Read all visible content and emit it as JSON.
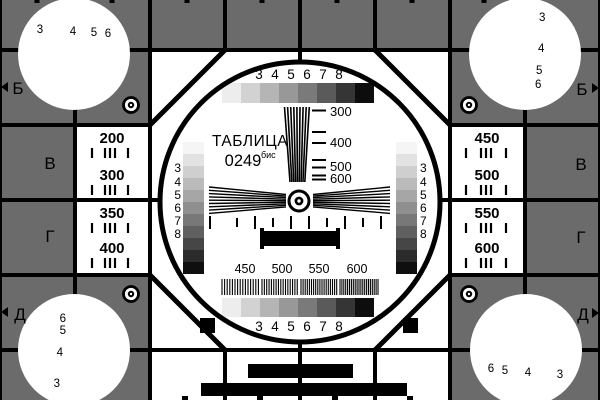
{
  "card": {
    "title_word": "ТАБЛИЦА",
    "title_number": "0249",
    "title_suffix": "бис"
  },
  "colors": {
    "background_gray": "#6b6b6b",
    "panel_white": "#ffffff",
    "line_black": "#000000"
  },
  "edge_markers": {
    "left": [
      "Б",
      "В",
      "Г",
      "Д"
    ],
    "right": [
      "Б",
      "В",
      "Г",
      "Д"
    ]
  },
  "gray_scale_labels": [
    "3",
    "4",
    "5",
    "6",
    "7",
    "8"
  ],
  "side_scale_labels": [
    "3",
    "4",
    "5",
    "6",
    "7",
    "8"
  ],
  "wedge_scale_labels": [
    "300",
    "400",
    "500",
    "600"
  ],
  "frequency_labels": [
    "450",
    "500",
    "550",
    "600"
  ],
  "left_cells": {
    "row1": [
      "200",
      "300"
    ],
    "row2": [
      "350",
      "400"
    ]
  },
  "right_cells": {
    "row1": [
      "450",
      "500"
    ],
    "row2": [
      "550",
      "600"
    ]
  },
  "corner_wedge_labels": {
    "top_left": [
      "3",
      "4",
      "5",
      "6"
    ],
    "top_right": [
      "3",
      "4",
      "5",
      "6"
    ],
    "bottom_left": [
      "6",
      "5",
      "4",
      "3"
    ],
    "bottom_right": [
      "6",
      "5",
      "4",
      "3"
    ]
  },
  "gray_steps_horizontal": [
    "#ededed",
    "#d2d2d2",
    "#b5b5b5",
    "#989898",
    "#7a7a7a",
    "#5a5a5a",
    "#353535",
    "#0d0d0d"
  ],
  "gray_steps_vertical": [
    "#f5f5f5",
    "#e2e2e2",
    "#cfcfcf",
    "#bbbbbb",
    "#a6a6a6",
    "#8f8f8f",
    "#787878",
    "#606060",
    "#464646",
    "#2b2b2b",
    "#0f0f0f"
  ],
  "grating_pitches": [
    2.6,
    2.35,
    2.1,
    1.9
  ]
}
